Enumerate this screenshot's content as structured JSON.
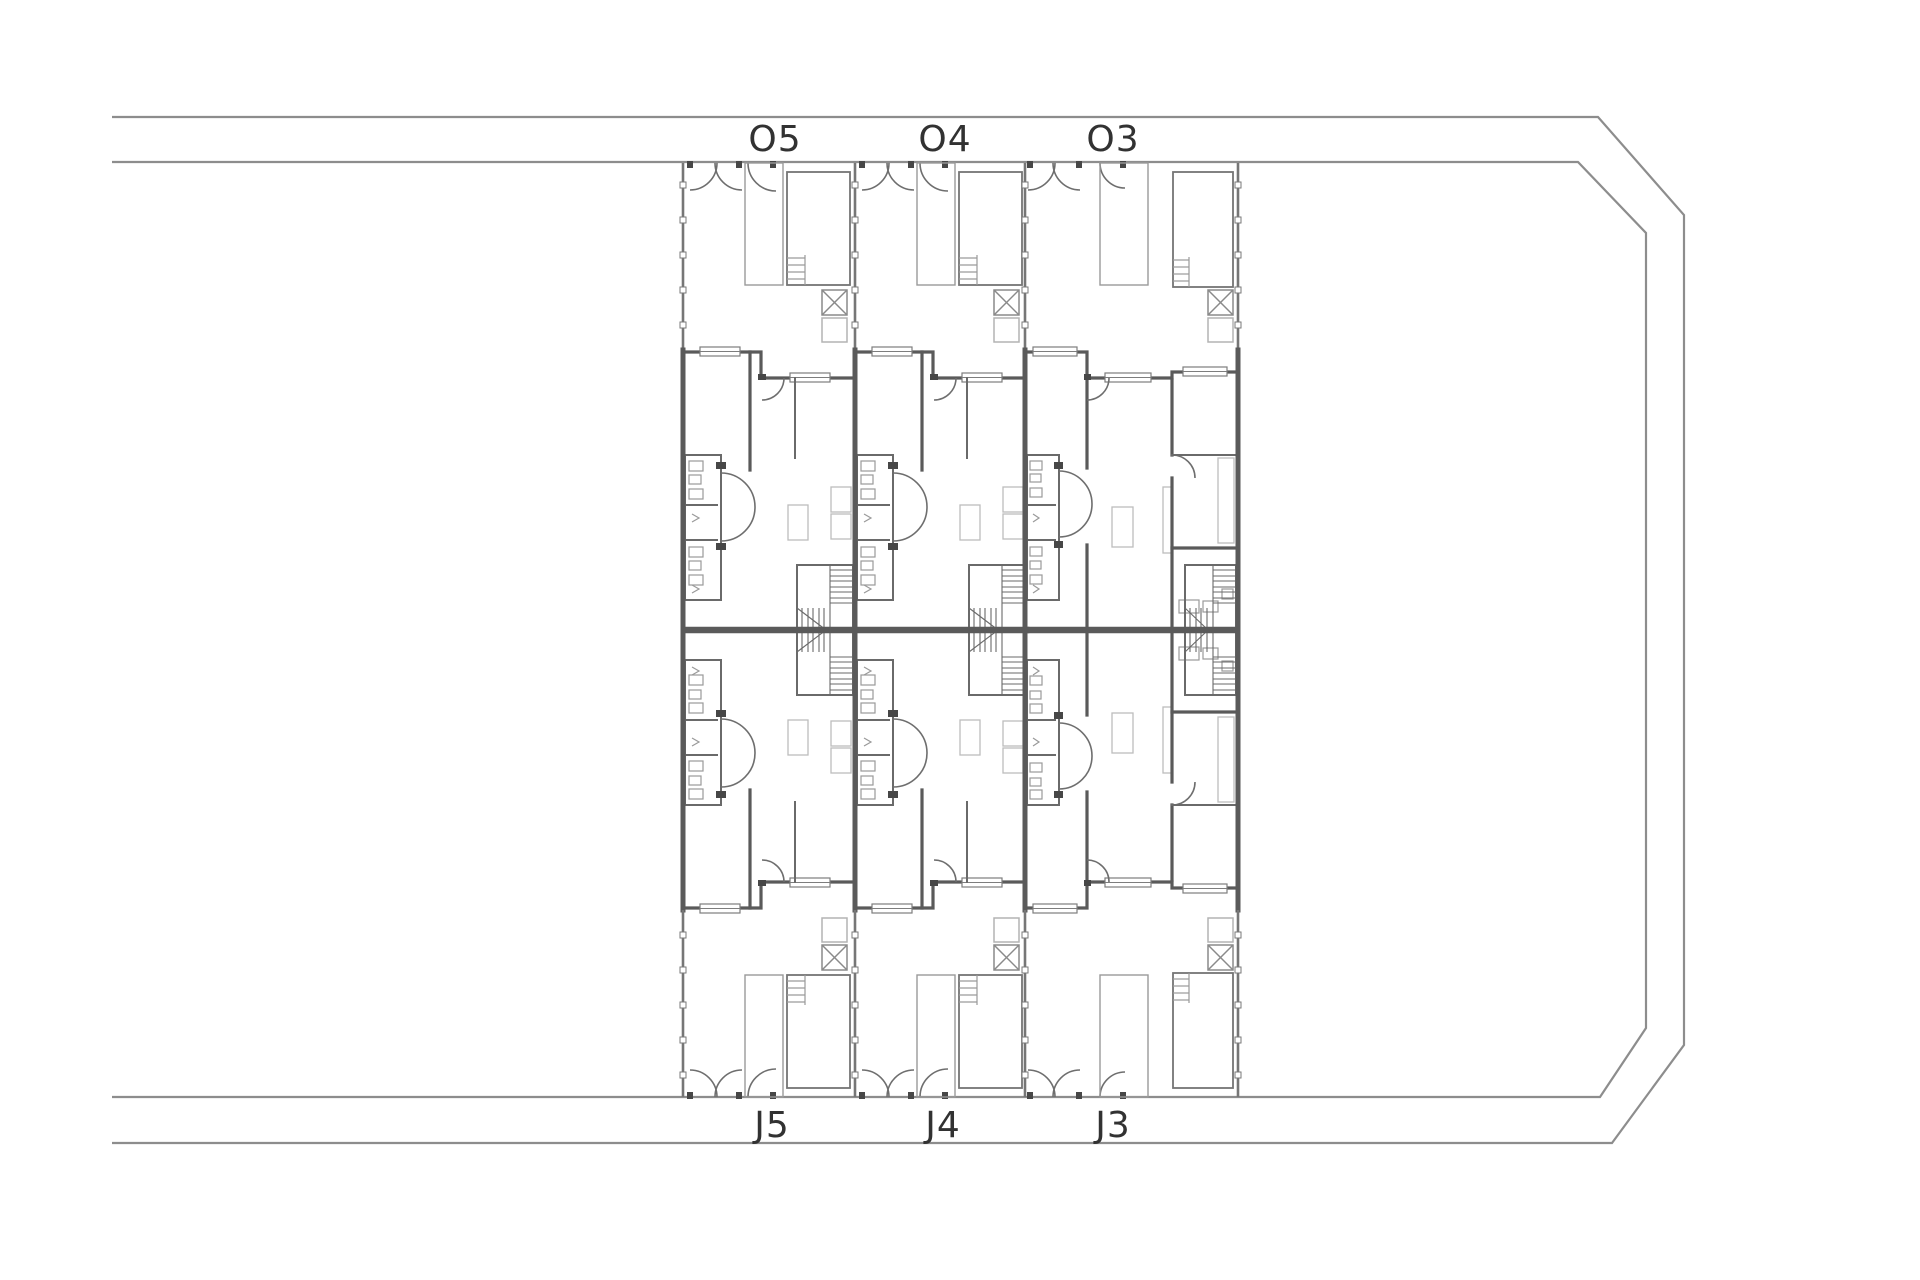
{
  "palette": {
    "background": "#ffffff",
    "boundary_line": "#8d8d8d",
    "wall_line": "#5a5a5a",
    "detail_line": "#9a9a9a",
    "label_text": "#323232"
  },
  "plan": {
    "units": [
      {
        "top_label": "O5",
        "bottom_label": "J5"
      },
      {
        "top_label": "O4",
        "bottom_label": "J4"
      },
      {
        "top_label": "O3",
        "bottom_label": "J3"
      }
    ]
  }
}
